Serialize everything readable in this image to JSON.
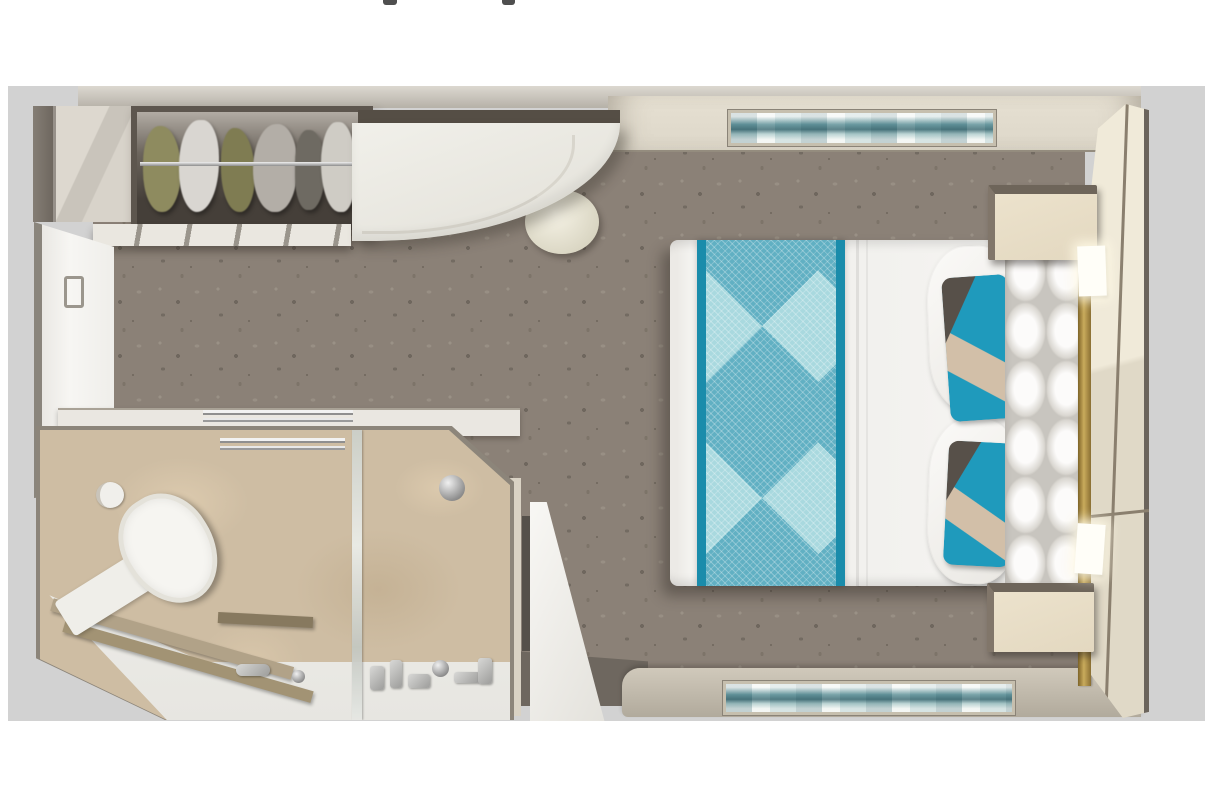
{
  "palette": {
    "page": "#ffffff",
    "margin": "#d2d2d2",
    "carpet": "#8b8177",
    "carpet-dark": "#736b62",
    "carpet-light": "#988f84",
    "wall-dark": "#6b645c",
    "cream-wall": "#ddd7c9",
    "cream-panel": "#e0d9c7",
    "teal": "#1f9abc",
    "teal-dark": "#1a8cab",
    "teal-light": "#8ec7d1",
    "pillow-tan": "#d2bfa8",
    "pillow-dark": "#575049",
    "marble": "#cebda3",
    "marble-light": "#dccaae",
    "marble-dark": "#c5b295",
    "nightstand": "#e3d8c0",
    "sconce": "#fffef8",
    "threshold": "#6e675f",
    "brass": "#c9ab5c",
    "chrome": "#b9b9b9"
  },
  "page": {
    "description": "Top-down 3D rendered floor plan of a cruise-ship stateroom on a white page with a light gray backdrop",
    "top_edge_cropped_glyph_fragments": 2
  },
  "floorplan": {
    "title": "Stateroom floor plan (top-down render)",
    "rooms": [
      {
        "name": "Bedroom with queen bed and desk"
      },
      {
        "name": "Bathroom with shower, toilet and vanity"
      },
      {
        "name": "Entry with door ajar"
      }
    ],
    "bedroom": {
      "furniture": [
        {
          "name": "Wardrobe with hanging clothes and chrome rail"
        },
        {
          "name": "Wardrobe side cabinet"
        },
        {
          "name": "Wardrobe drawer fronts"
        },
        {
          "name": "Curved white desk / vanity with dark trim"
        },
        {
          "name": "Round cream stool"
        },
        {
          "name": "Queen bed with white duvet"
        },
        {
          "name": "Teal diamond-pattern bed runner"
        },
        {
          "name": "White bed pillows"
        },
        {
          "name": "Teal and tan accent pillow (upper)"
        },
        {
          "name": "Teal and tan accent pillow (lower)"
        },
        {
          "name": "White tufted headboard"
        },
        {
          "name": "Brass trim strip"
        },
        {
          "name": "Nightstand (upper)"
        },
        {
          "name": "Nightstand (lower)"
        },
        {
          "name": "Lit wall sconce (upper)"
        },
        {
          "name": "Lit wall sconce (lower)"
        },
        {
          "name": "Teal seascape artwork (top wall)"
        },
        {
          "name": "Teal seascape artwork (bottom wall)"
        },
        {
          "name": "Cream paneled headboard wall"
        },
        {
          "name": "Mottled gray carpet"
        },
        {
          "name": "Open interior door against left wall"
        }
      ]
    },
    "bathroom": {
      "fixtures": [
        {
          "name": "Toilet"
        },
        {
          "name": "Toilet cistern ledge"
        },
        {
          "name": "Toilet paper roll"
        },
        {
          "name": "White vanity counter with sink faucet"
        },
        {
          "name": "Wooden towel ledges"
        },
        {
          "name": "Walk-in shower with glass panel"
        },
        {
          "name": "Chrome shower head"
        },
        {
          "name": "Shower fittings and toiletries"
        },
        {
          "name": "Chrome towel bar"
        },
        {
          "name": "Beige marble walls and floor"
        }
      ]
    },
    "entry": {
      "fixtures": [
        {
          "name": "Entry door shown ajar"
        },
        {
          "name": "Dark threshold floor"
        },
        {
          "name": "Door jamb"
        }
      ]
    }
  }
}
